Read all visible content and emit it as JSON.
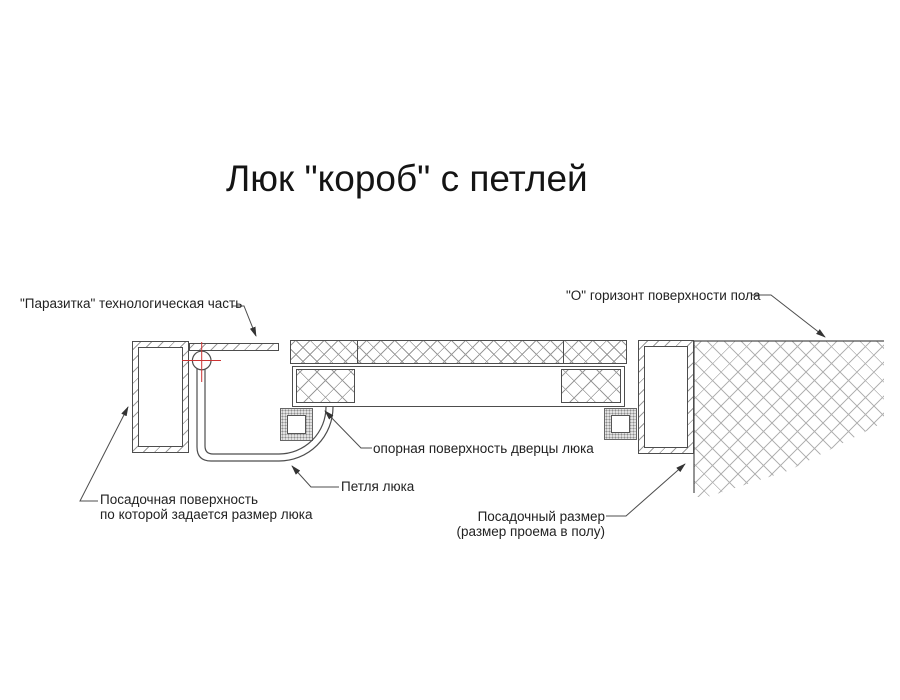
{
  "diagram": {
    "title": "Люк \"короб\" с петлей",
    "labels": {
      "parazitka": "\"Паразитка\" технологическая часть",
      "horizon": "\"О\" горизонт поверхности пола",
      "opornaya": "опорная поверхность дверцы люка",
      "petlya": "Петля люка",
      "posad_poverhnost_line1": "Посадочная поверхность",
      "posad_poverhnost_line2": "по которой задается размер люка",
      "posad_razmer_line1": "Посадочный размер",
      "posad_razmer_line2": "(размер проема в полу)"
    },
    "colors": {
      "background": "#ffffff",
      "line": "#4d4d4d",
      "hatch": "#9a9a9a",
      "floor_hatch": "#b3b3b3",
      "crosshair_red": "#cc3333",
      "text": "#222222"
    }
  }
}
